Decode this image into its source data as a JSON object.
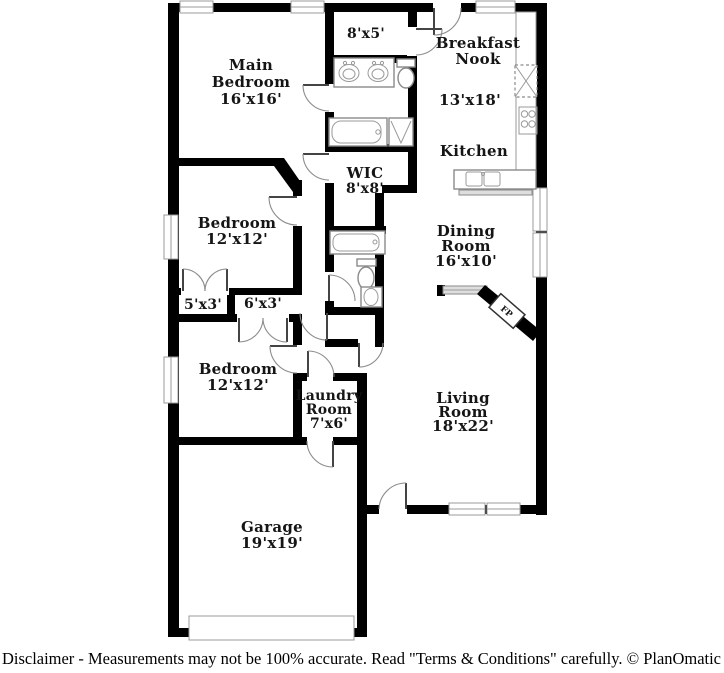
{
  "plan": {
    "rooms": {
      "main_bedroom": {
        "name_line1": "Main",
        "name_line2": "Bedroom",
        "dims": "16'x16'"
      },
      "bath_top": {
        "dims": "8'x5'"
      },
      "breakfast_nook": {
        "name_line1": "Breakfast",
        "name_line2": "Nook",
        "dims": "13'x18'"
      },
      "kitchen": {
        "name": "Kitchen"
      },
      "wic": {
        "name": "WIC",
        "dims": "8'x8'"
      },
      "bedroom_1": {
        "name": "Bedroom",
        "dims": "12'x12'"
      },
      "dining": {
        "name_line1": "Dining",
        "name_line2": "Room",
        "dims": "16'x10'"
      },
      "closet_small": {
        "dims": "5'x3'"
      },
      "closet_large": {
        "dims": "6'x3'"
      },
      "bedroom_2": {
        "name": "Bedroom",
        "dims": "12'x12'"
      },
      "laundry": {
        "name_line1": "Laundry",
        "name_line2": "Room",
        "dims": "7'x6'"
      },
      "living": {
        "name_line1": "Living",
        "name_line2": "Room",
        "dims": "18'x22'"
      },
      "garage": {
        "name": "Garage",
        "dims": "19'x19'"
      },
      "fireplace": {
        "label": "FP"
      }
    },
    "footer": {
      "disclaimer": "Disclaimer - Measurements may not be 100% accurate. Read \"Terms & Conditions\" carefully. © PlanOmatic"
    },
    "colors": {
      "wall": "#000000",
      "label_text": "#151515",
      "fixture_stroke": "#8a8a8a",
      "window_stroke": "#9b9b9b",
      "background": "#ffffff"
    }
  }
}
